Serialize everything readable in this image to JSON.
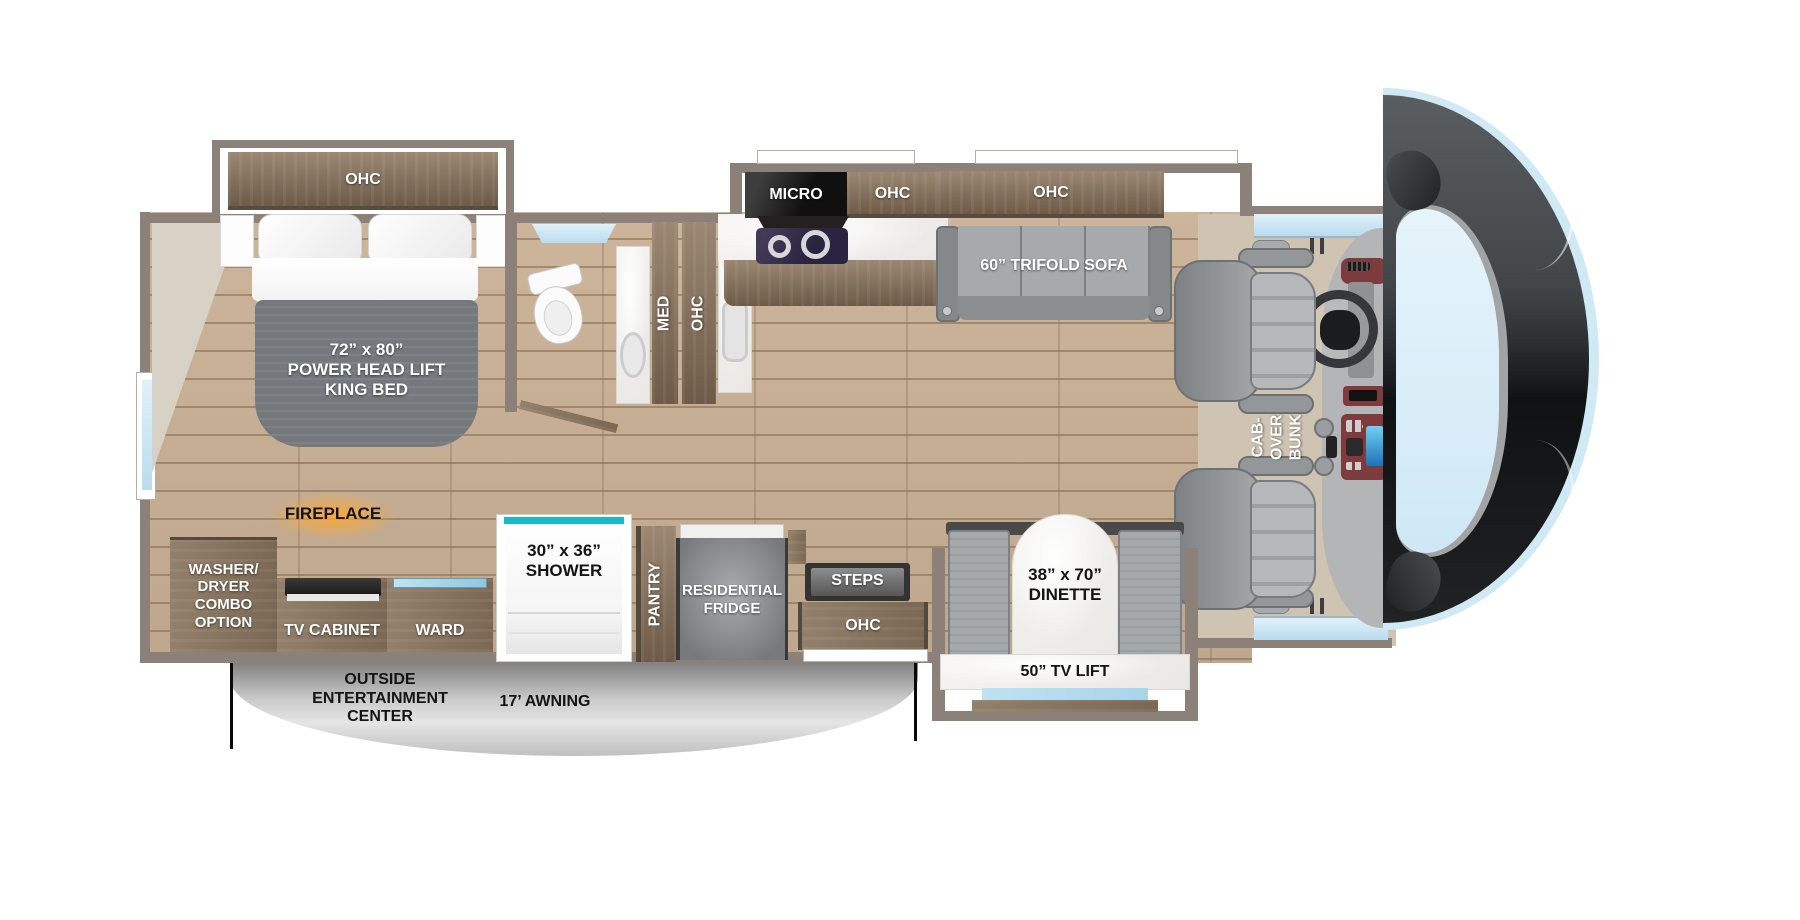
{
  "diagram": {
    "type": "rv-motorhome-floorplan",
    "bedroom": {
      "ohc_label": "OHC",
      "bed_label": "72” x 80”\nPOWER HEAD LIFT\nKING BED"
    },
    "bathroom": {
      "med_label": "MED",
      "ohc_label": "OHC"
    },
    "kitchen": {
      "micro_label": "MICRO",
      "ohc_left_label": "OHC",
      "ohc_right_label": "OHC"
    },
    "living": {
      "sofa_label": "60” TRIFOLD SOFA"
    },
    "cab": {
      "bunk_label": "CAB-OVER\nBUNK"
    },
    "storage": {
      "washer_label": "WASHER/\nDRYER\nCOMBO\nOPTION",
      "fireplace_label": "FIREPLACE",
      "tv_cabinet_label": "TV CABINET",
      "ward_label": "WARD",
      "shower_label": "30” x 36”\nSHOWER",
      "pantry_label": "PANTRY",
      "fridge_label": "RESIDENTIAL\nFRIDGE",
      "steps_label": "STEPS",
      "door_ohc_label": "OHC"
    },
    "dinette": {
      "table_label": "38” x 70”\nDINETTE",
      "tv_lift_label": "50” TV LIFT"
    },
    "exterior": {
      "outside_label": "OUTSIDE\nENTERTAINMENT\nCENTER",
      "awning_label": "17’ AWNING"
    },
    "colors": {
      "wall": "#8b8178",
      "wood": "#83705c",
      "floor": "#c8af96",
      "cab_floor": "#cfc3b2",
      "window_blue": "#cde7f5",
      "shower_teal": "#19b9c9",
      "mattress_gray": "#74787d",
      "sofa_gray": "#9fa2a5",
      "marble_white": "#f3f2ef",
      "awning_gray": "#c9c9c9",
      "fireplace_glow": "#ffa82e",
      "front_cap_dark": "#232527",
      "cooktop_dark": "#2e2840"
    }
  }
}
